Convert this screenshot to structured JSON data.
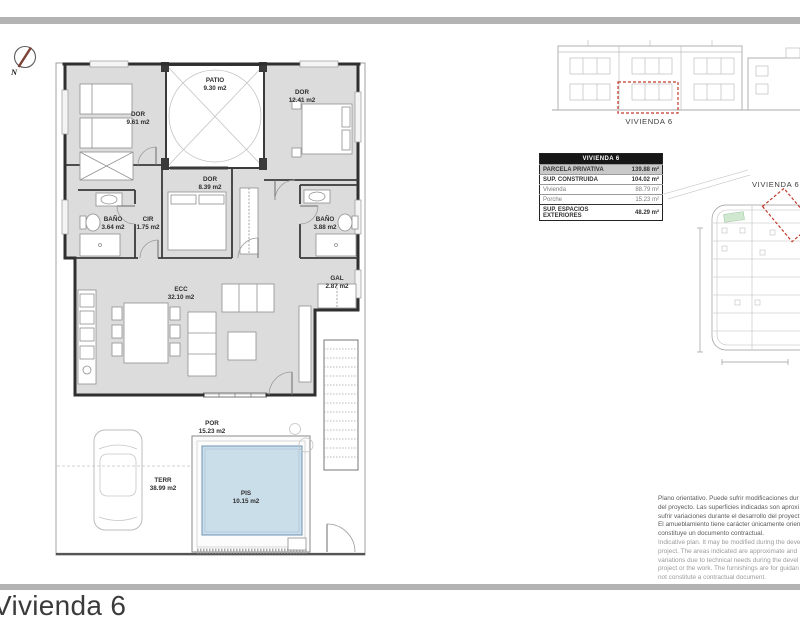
{
  "page": {
    "title": "Vivienda 6"
  },
  "compass": {
    "north_label": "N"
  },
  "plan": {
    "rooms": [
      {
        "name": "DOR",
        "area": "9.61 m2"
      },
      {
        "name": "PATIO",
        "area": "9.30 m2"
      },
      {
        "name": "DOR",
        "area": "12.41 m2"
      },
      {
        "name": "DOR",
        "area": "8.39 m2"
      },
      {
        "name": "BAÑO",
        "area": "3.64 m2"
      },
      {
        "name": "CIR",
        "area": "1.75 m2"
      },
      {
        "name": "BAÑO",
        "area": "3.88 m2"
      },
      {
        "name": "ECC",
        "area": "32.10 m2"
      },
      {
        "name": "GAL",
        "area": "2.87 m2"
      },
      {
        "name": "POR",
        "area": "15.23 m2"
      },
      {
        "name": "TERR",
        "area": "38.99 m2"
      },
      {
        "name": "PIS",
        "area": "10.15 m2"
      }
    ]
  },
  "elevation": {
    "label": "VIVIENDA 6"
  },
  "site_plan": {
    "label": "VIVIENDA 6"
  },
  "summary_table": {
    "header": "VIVIENDA 6",
    "rows": [
      {
        "label": "PARCELA PRIVATIVA",
        "value": "139.88 m²"
      },
      {
        "label": "SUP. CONSTRUIDA",
        "value": "104.02 m²"
      },
      {
        "label": "Vivienda",
        "value": "88.79 m²"
      },
      {
        "label": "Porche",
        "value": "15.23 m²"
      },
      {
        "label": "SUP. ESPACIOS EXTERIORES",
        "value": "48.29 m²"
      }
    ]
  },
  "disclaimer": {
    "es_lines": [
      "Plano orientativo. Puede sufrir modificaciones dur",
      "del proyecto. Las superficies indicadas son aproxi",
      "sufrir variaciones durante el desarrollo del proyect",
      "El amueblamiento tiene carácter únicamente orien",
      "constituye un documento contractual."
    ],
    "en_lines": [
      "Indicative plan. It may be modified during the deve",
      "project. The areas indicated are approximate and",
      "variations due to technical needs during the devel",
      "project or the work. The furnishings are for guidan",
      "not constitute a contractual document."
    ]
  },
  "colors": {
    "accent_red": "#c23b2b",
    "pool_blue": "#cadeea",
    "room_gray": "#dcdcdc",
    "bar_gray": "#b3b3b3"
  }
}
